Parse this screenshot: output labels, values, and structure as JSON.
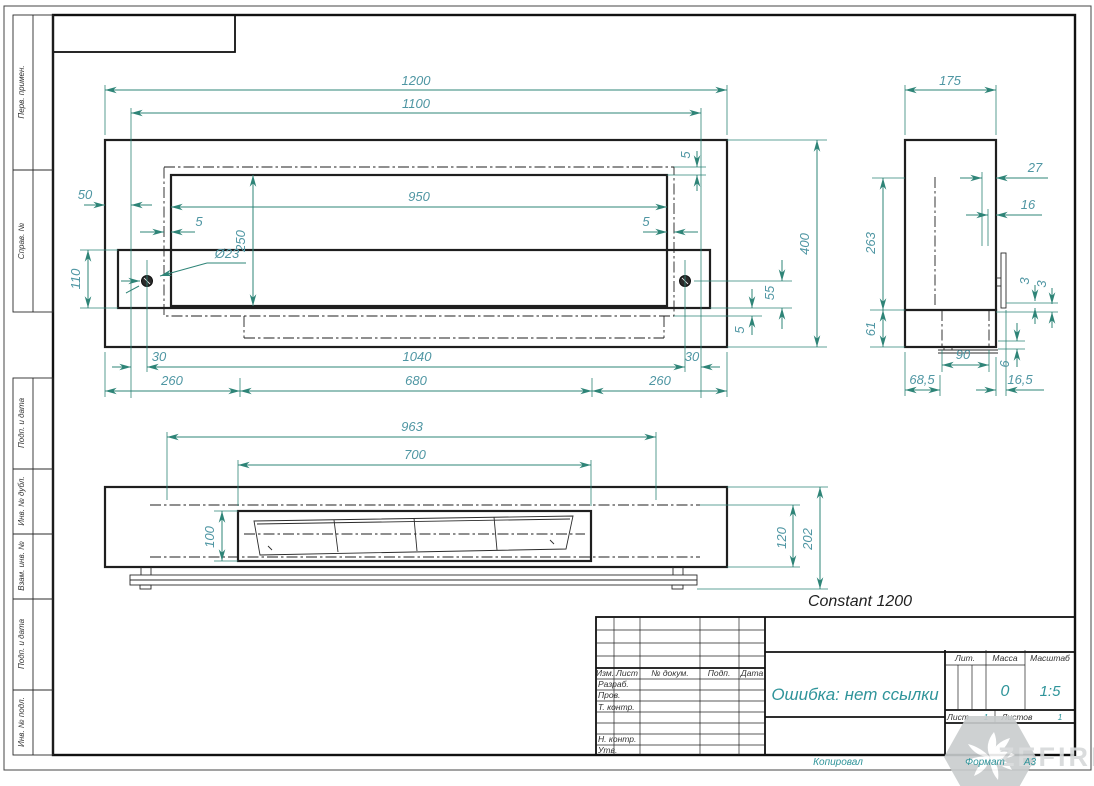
{
  "product_label": "Constant 1200",
  "watermark": "ZEFIRE",
  "dims": {
    "front": {
      "w_outer": "1200",
      "w_frame": "1100",
      "w_window": "950",
      "h_window": "250",
      "gap_top": "5",
      "gap_left": "5",
      "gap_right": "5",
      "gap_bottom": "5",
      "offset_left": "50",
      "h_band": "110",
      "hole_dia": "Ø23",
      "h_outer": "400",
      "h_bolt": "55",
      "edge_left": "30",
      "w_holes": "1040",
      "edge_right": "30",
      "leg_left": "260",
      "leg_center": "680",
      "leg_right": "260"
    },
    "bottom": {
      "w_glass": "963",
      "w_burner": "700",
      "d_burner": "100",
      "d_inner": "120",
      "d_total": "202"
    },
    "side": {
      "d_outer": "175",
      "off_top": "27",
      "off_mid": "16",
      "h_inner": "263",
      "t_plate1": "3",
      "t_plate2": "3",
      "h_base": "61",
      "w_base": "90",
      "t_rail": "6",
      "off_left": "68,5",
      "off_right": "16,5"
    }
  },
  "margin_labels": [
    "Перв. примен.",
    "Справ. №",
    "Подп. и дата",
    "Инв. № дубл.",
    "Взам. инв. №",
    "Подп. и дата",
    "Инв. № подл."
  ],
  "title_block": {
    "rev_cols": [
      "Изм.",
      "Лист",
      "№ докум.",
      "Подп.",
      "Дата"
    ],
    "sign_rows": [
      "Разраб.",
      "Пров.",
      "Т. контр.",
      "Н. контр.",
      "Утв."
    ],
    "doc_title": "Ошибка: нет ссылки",
    "lit_label": "Лит.",
    "mass_label": "Масса",
    "scale_label": "Масштаб",
    "mass_value": "0",
    "scale_value": "1:5",
    "sheet_label": "Лист",
    "sheet_value": "1",
    "sheets_label": "Листов",
    "sheets_value": "1",
    "copied_label": "Копировал",
    "format_label": "Формат",
    "format_value": "А3"
  },
  "colors": {
    "dim_line": "#2e8477",
    "dim_text": "#4f96a3",
    "fill_text": "#2f949a",
    "ink": "#1f1f1f"
  }
}
